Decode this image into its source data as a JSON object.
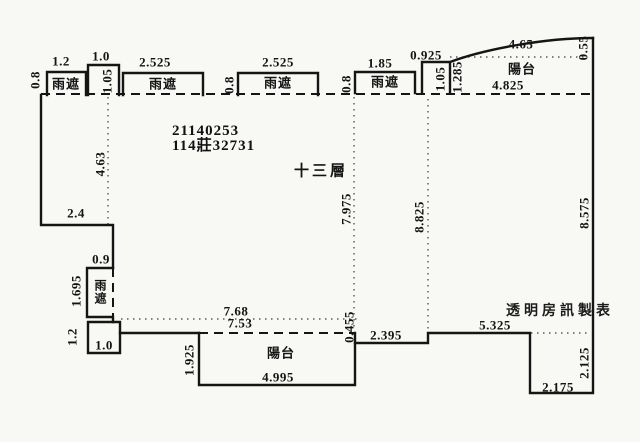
{
  "plan": {
    "unit_number": "21140253",
    "permit_number": "114莊32731",
    "floor_label": "十三層",
    "watermark": "透明房訊製表",
    "rain_shield_label": "雨遮",
    "balcony_label": "陽台",
    "line_color": "#151515",
    "background_color": "#f8f8f5"
  },
  "dims": [
    {
      "id": "rainshield1-depth",
      "text": "0.8"
    },
    {
      "id": "rainshield1-width",
      "text": "1.2"
    },
    {
      "id": "top-bump-width",
      "text": "1.0"
    },
    {
      "id": "top-bump-height",
      "text": "1.05"
    },
    {
      "id": "rainshield2-width",
      "text": "2.525"
    },
    {
      "id": "rainshield3-depth",
      "text": "0.8"
    },
    {
      "id": "rainshield3-width",
      "text": "2.525"
    },
    {
      "id": "rainshield4-depth",
      "text": "0.8"
    },
    {
      "id": "rainshield4-width",
      "text": "1.85"
    },
    {
      "id": "tr-bump-width",
      "text": "0.925"
    },
    {
      "id": "tr-bump-height",
      "text": "1.05"
    },
    {
      "id": "tr-balcony-depth",
      "text": "1.285"
    },
    {
      "id": "tr-balcony-curve",
      "text": "4.65"
    },
    {
      "id": "tr-balcony-right",
      "text": "0.55"
    },
    {
      "id": "tr-balcony-width",
      "text": "4.825"
    },
    {
      "id": "left-wall-height",
      "text": "4.63"
    },
    {
      "id": "left-step-width",
      "text": "2.4"
    },
    {
      "id": "left-rainshield-width",
      "text": "0.9"
    },
    {
      "id": "left-rainshield-height",
      "text": "1.695"
    },
    {
      "id": "bl-box-height",
      "text": "1.2"
    },
    {
      "id": "bl-box-width",
      "text": "1.0"
    },
    {
      "id": "mid-height",
      "text": "7.975"
    },
    {
      "id": "mid-right-height",
      "text": "8.825"
    },
    {
      "id": "right-wall-height",
      "text": "8.575"
    },
    {
      "id": "bottom-upper-width",
      "text": "7.68"
    },
    {
      "id": "bottom-lower-width",
      "text": "7.53"
    },
    {
      "id": "balcony-depth",
      "text": "1.925"
    },
    {
      "id": "balcony-width",
      "text": "4.995"
    },
    {
      "id": "step-height",
      "text": "0.455"
    },
    {
      "id": "step-run-width",
      "text": "2.395"
    },
    {
      "id": "br-run-width",
      "text": "5.325"
    },
    {
      "id": "br-notch-height",
      "text": "2.125"
    },
    {
      "id": "br-notch-width",
      "text": "2.175"
    }
  ]
}
